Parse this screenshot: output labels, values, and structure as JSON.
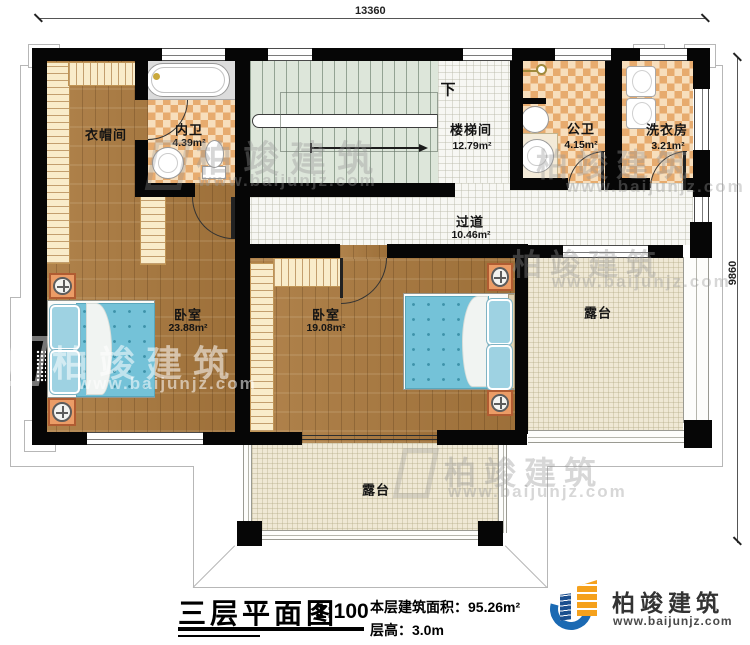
{
  "plan": {
    "dimensions": {
      "width_label": "13360",
      "depth_label": "9860"
    },
    "rooms": {
      "cloakroom": {
        "name": "衣帽间"
      },
      "ensuite_bath": {
        "name": "内卫",
        "area": "4.39m²"
      },
      "stairwell": {
        "name": "楼梯间",
        "area": "12.79m²"
      },
      "public_bath": {
        "name": "公卫",
        "area": "4.15m²"
      },
      "laundry": {
        "name": "洗衣房",
        "area": "3.21m²"
      },
      "corridor": {
        "name": "过道",
        "area": "10.46m²"
      },
      "bedroom_left": {
        "name": "卧室",
        "area": "23.88m²"
      },
      "bedroom_right": {
        "name": "卧室",
        "area": "19.08m²"
      },
      "terrace_right": {
        "name": "露台"
      },
      "terrace_bottom": {
        "name": "露台"
      }
    },
    "stairs": {
      "down_label": "下"
    }
  },
  "title_block": {
    "title": "三层平面图",
    "scale": "1:100",
    "floor_area_label": "本层建筑面积：",
    "floor_area_value": "95.26m²",
    "floor_height_label": "层高：",
    "floor_height_value": "3.0m"
  },
  "brand": {
    "name": "柏竣建筑",
    "website": "www.baijunjz.com"
  },
  "colors": {
    "wall": "#060606",
    "wood_floor": "#aa793e",
    "tile_accent": "#e7ab6e",
    "stair_floor": "#dde6da",
    "terrace_floor": "#efe8d5",
    "bed": "#74c2d8",
    "brand_blue": "#1b6ab3",
    "brand_orange": "#f5a11c"
  }
}
